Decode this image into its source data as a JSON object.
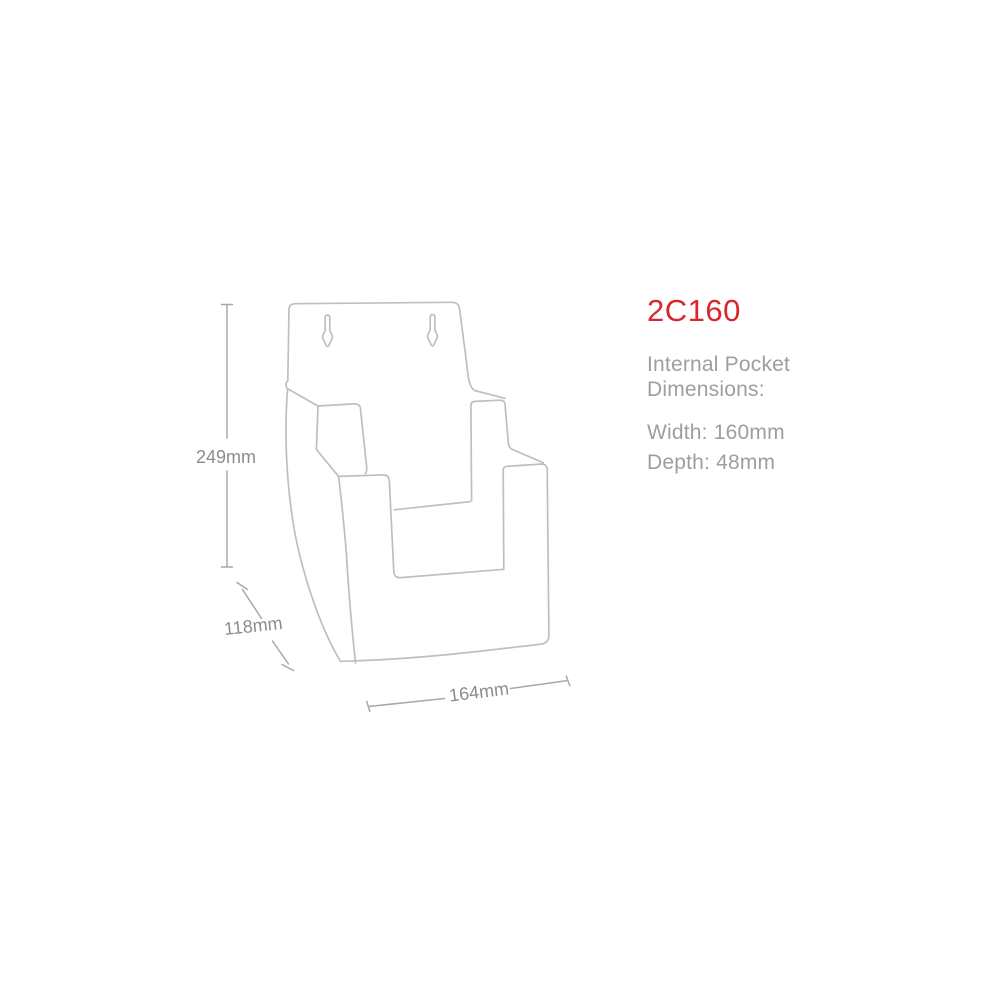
{
  "diagram": {
    "line_color": "#bfbfbf",
    "dim_line_color": "#a8a8a8",
    "label_color": "#8c8c8c",
    "height_label": "249mm",
    "depth_label": "118mm",
    "width_label": "164mm"
  },
  "product_info": {
    "code": "2C160",
    "code_color": "#d9262c",
    "heading_line1": "Internal Pocket",
    "heading_line2": "Dimensions:",
    "width_spec": "Width: 160mm",
    "depth_spec": "Depth: 48mm",
    "text_color": "#9e9e9e"
  }
}
